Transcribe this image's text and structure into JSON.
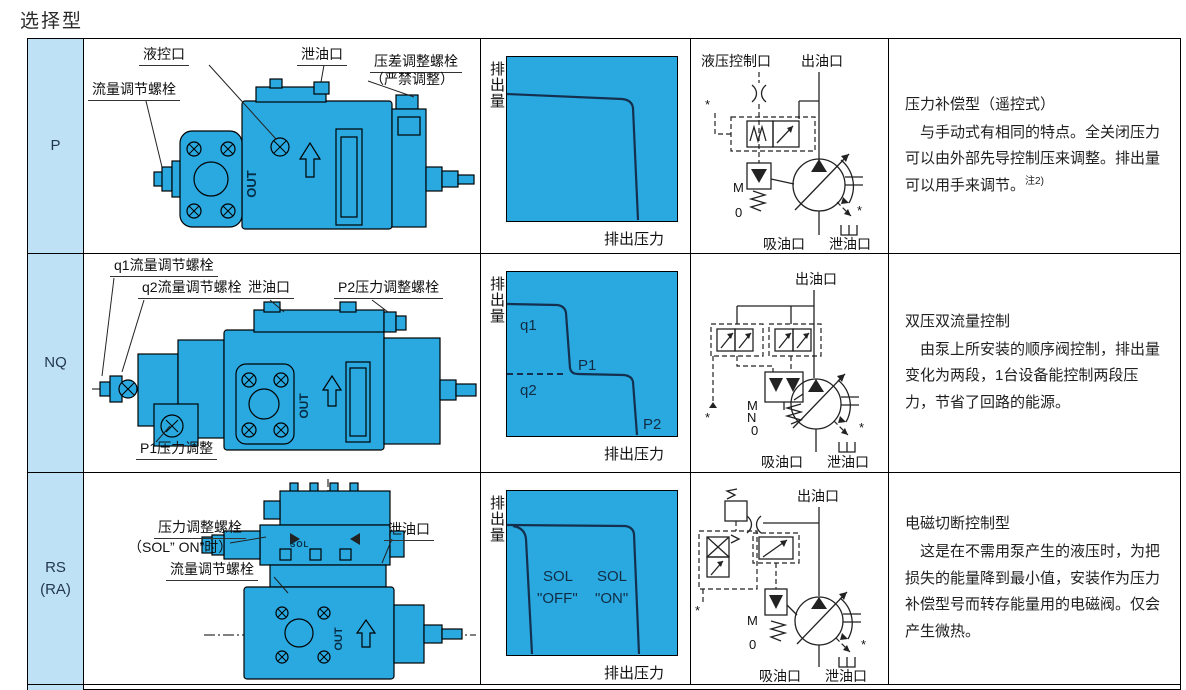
{
  "page_title": "选择型",
  "colors": {
    "pump_blue": "#29a9e0",
    "panel_blue": "#bfe1f5",
    "curve_navy": "#14304e"
  },
  "rows": [
    {
      "type_label": "P",
      "pump": {
        "out_text": "OUT",
        "callouts": {
          "pilot_port": "液控口",
          "drain_port": "泄油口",
          "diff_bolt": "压差调整螺栓",
          "diff_bolt_note": "（严禁调整）",
          "flow_bolt": "流量调节螺栓"
        }
      },
      "chart": {
        "ylabel": "排出量",
        "xlabel": "排出压力"
      },
      "circuit": {
        "pilot_port": "液压控制口",
        "outlet_port": "出油口",
        "suction_port": "吸油口",
        "drain_port": "泄油口",
        "m_label": "M",
        "zero_label": "0",
        "star": "*"
      },
      "desc": {
        "title": "压力补偿型（遥控式）",
        "body": "与手动式有相同的特点。全关闭压力可以由外部先导控制压来调整。排出量可以用手来调节。",
        "note": "注2)"
      }
    },
    {
      "type_label": "NQ",
      "pump": {
        "out_text": "OUT",
        "callouts": {
          "q1_bolt": "q1流量调节螺栓",
          "q2_bolt": "q2流量调节螺栓",
          "drain_port": "泄油口",
          "p2_bolt": "P2压力调整螺栓",
          "p1_adjust": "P1压力调整"
        }
      },
      "chart": {
        "ylabel": "排出量",
        "xlabel": "排出压力",
        "q1": "q1",
        "q2": "q2",
        "p1": "P1",
        "p2": "P2"
      },
      "circuit": {
        "outlet_port": "出油口",
        "suction_port": "吸油口",
        "drain_port": "泄油口",
        "m_label": "M",
        "n_label": "N",
        "zero_label": "0",
        "star": "*"
      },
      "desc": {
        "title": "双压双流量控制",
        "body": "由泵上所安装的顺序阀控制，排出量变化为两段，1台设备能控制两段压力，节省了回路的能源。"
      }
    },
    {
      "type_label_line1": "RS",
      "type_label_line2": "(RA)",
      "pump": {
        "out_text": "OUT",
        "sol_text": "SOL",
        "callouts": {
          "pressure_bolt": "压力调整螺栓",
          "pressure_bolt_note": "（SOL” ON”时）",
          "drain_port": "泄油口",
          "flow_bolt": "流量调节螺栓"
        }
      },
      "chart": {
        "ylabel": "排出量",
        "xlabel": "排出压力",
        "sol_off_line1": "SOL",
        "sol_off_line2": "\"OFF\"",
        "sol_on_line1": "SOL",
        "sol_on_line2": "\"ON\""
      },
      "circuit": {
        "outlet_port": "出油口",
        "suction_port": "吸油口",
        "drain_port": "泄油口",
        "m_label": "M",
        "zero_label": "0",
        "star": "*"
      },
      "desc": {
        "title": "电磁切断控制型",
        "body": "这是在不需用泵产生的液压时，为把损失的能量降到最小值，安装作为压力补偿型号而转存能量用的电磁阀。仅会产生微热。"
      }
    }
  ],
  "chart_data": [
    {
      "type": "line",
      "title": "P型 压力-流量特性",
      "xlabel": "排出压力",
      "ylabel": "排出量",
      "series": [
        {
          "name": "压力补偿特性",
          "shape": "恒流量后在全关闭压力处陡降为0"
        }
      ],
      "annotations": []
    },
    {
      "type": "line",
      "title": "NQ型 双压双流量特性",
      "xlabel": "排出压力",
      "ylabel": "排出量",
      "series": [
        {
          "name": "两段特性",
          "shape": "流量q1保持至压力P1，降至q2保持至P2后降为0"
        }
      ],
      "annotations": [
        "q1",
        "q2",
        "P1",
        "P2"
      ]
    },
    {
      "type": "line",
      "title": "RS(RA)型 电磁切断特性",
      "xlabel": "排出压力",
      "ylabel": "排出量",
      "series": [
        {
          "name": "SOL \"OFF\"",
          "shape": "低压处即切断"
        },
        {
          "name": "SOL \"ON\"",
          "shape": "高压全关闭处切断"
        }
      ],
      "annotations": [
        "SOL \"OFF\"",
        "SOL \"ON\""
      ]
    }
  ]
}
